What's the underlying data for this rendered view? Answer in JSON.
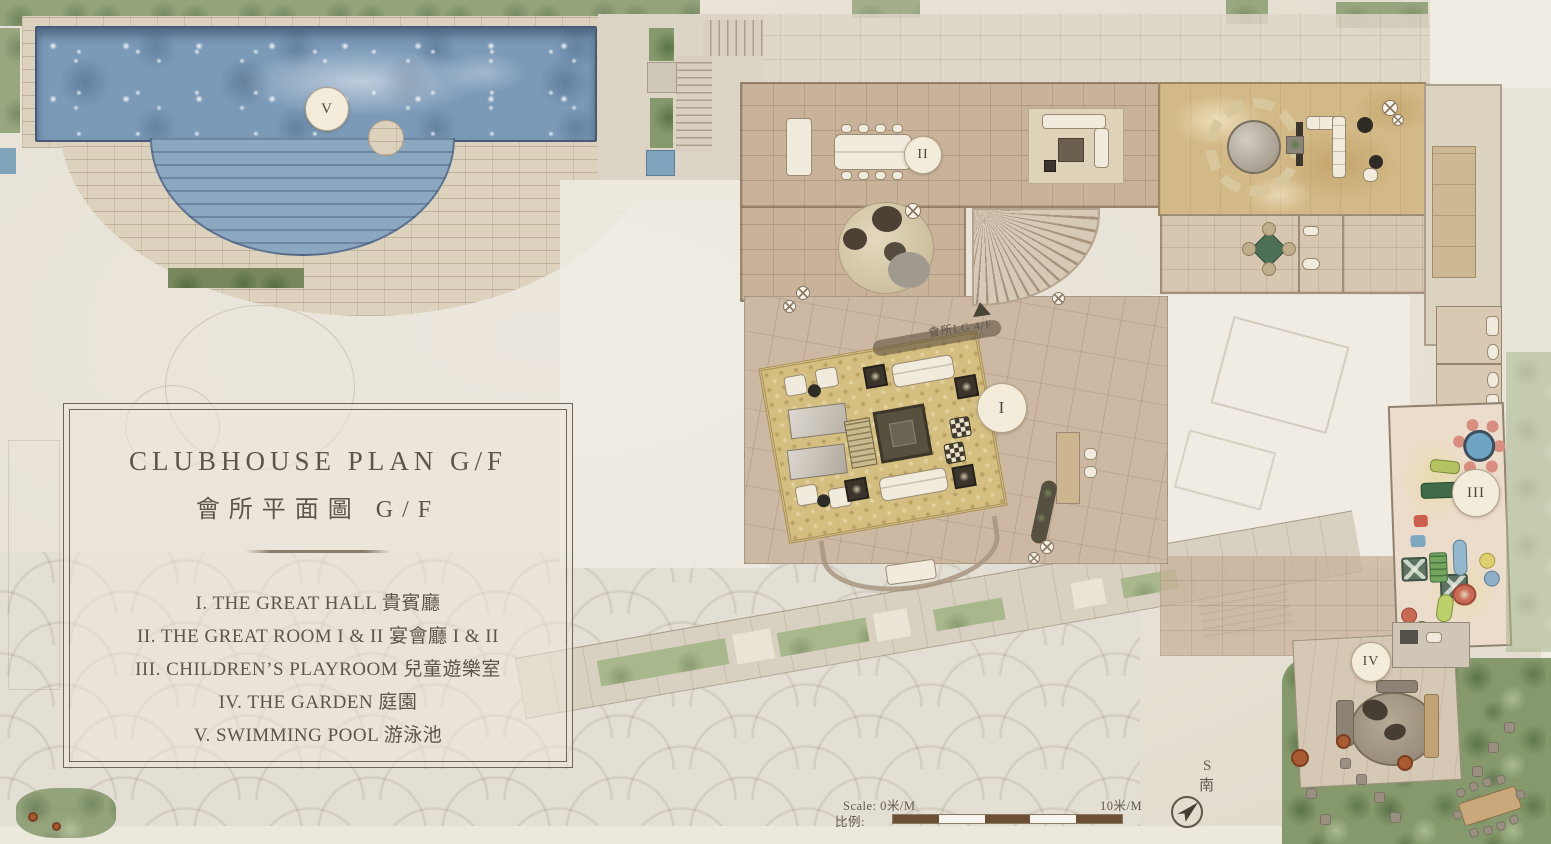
{
  "panel": {
    "title_en": "CLUBHOUSE PLAN G/F",
    "title_zh": "會所平面圖 G/F",
    "items": [
      {
        "text": "I. THE GREAT HALL 貴賓廳"
      },
      {
        "text": "II. THE GREAT ROOM I & II 宴會廳 I & II"
      },
      {
        "text": "III. CHILDREN’S PLAYROOM 兒童遊樂室"
      },
      {
        "text": "IV. THE GARDEN 庭園"
      },
      {
        "text": "V. SWIMMING POOL 游泳池"
      }
    ]
  },
  "markers": [
    {
      "label": "V"
    },
    {
      "label": "II"
    },
    {
      "label": "I"
    },
    {
      "label": "III"
    },
    {
      "label": "IV"
    }
  ],
  "annotations": {
    "stair_note": "會所LG 4/F"
  },
  "scale_bar": {
    "left_label": "Scale: 0米/M",
    "right_label": "10米/M",
    "ratio_label": "比例:"
  },
  "compass": {
    "letter": "S",
    "char": "南"
  },
  "colors": {
    "pool_blue": "#7b9ab8",
    "carpet_gold": "#d4bf80",
    "foliage_green": "#86996c",
    "scale_brown": "#6d4f35",
    "panel_text": "#5c554a"
  }
}
